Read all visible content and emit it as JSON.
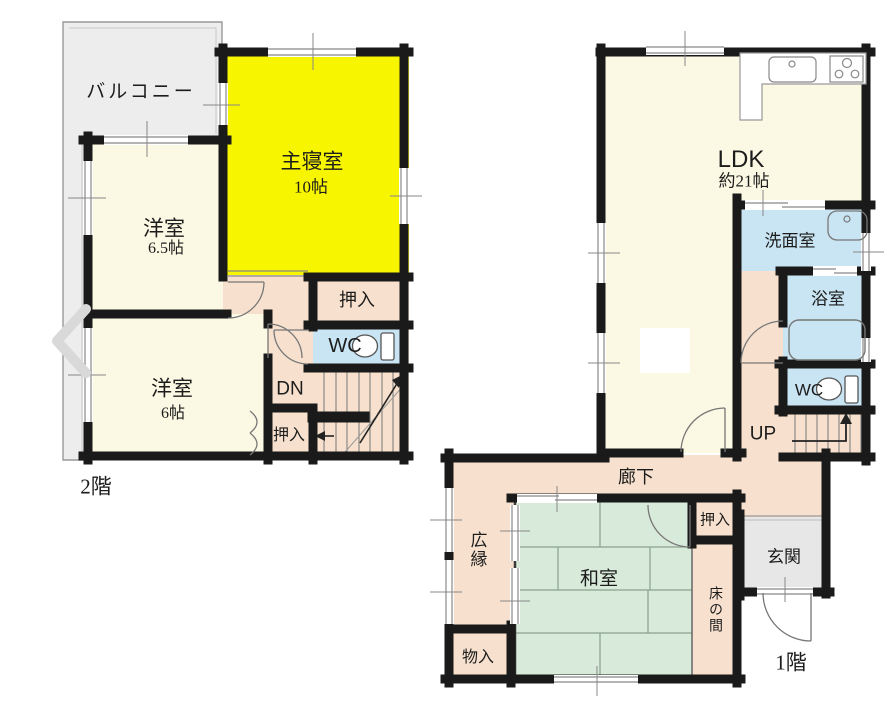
{
  "title": "間取り図",
  "colors": {
    "wall": "#1a1a1a",
    "room_cream": "#fbf8e3",
    "room_yellow": "#f8f500",
    "hall_peach": "#f7e1ce",
    "wet_blue": "#c9e4f2",
    "tatami_green": "#d8ead9",
    "balcony_gray": "#ededed",
    "entrance_gray": "#e7e7e7"
  },
  "icons": {
    "chevron_left": "carousel previous arrow",
    "toilet": "toilet bowl with tank",
    "sink": "kitchen sink with faucet",
    "stove": "3-burner stove",
    "bathtub": "bathtub outline",
    "washbasin": "wash basin",
    "stairs_up_arrow": "up direction arrow",
    "stairs_down_arrow": "down direction arrow"
  },
  "floor2": {
    "floor_label": "2階",
    "balcony": "バルコニー",
    "master": {
      "name": "主寝室",
      "size": "10帖"
    },
    "western65": {
      "name": "洋室",
      "size": "6.5帖"
    },
    "western6": {
      "name": "洋室",
      "size": "6帖"
    },
    "closet_top": "押入",
    "closet_bottom": "押入",
    "wc": "WC",
    "dn": "DN"
  },
  "floor1": {
    "floor_label": "1階",
    "ldk": {
      "name": "LDK",
      "size": "約21帖"
    },
    "washroom": "洗面室",
    "bathroom": "浴室",
    "wc": "WC",
    "up": "UP",
    "hallway": "廊下",
    "veranda": "広縁",
    "japanese_room": "和室",
    "closet": "押入",
    "entrance": "玄関",
    "tokonoma": "床の間",
    "storage": "物入"
  }
}
